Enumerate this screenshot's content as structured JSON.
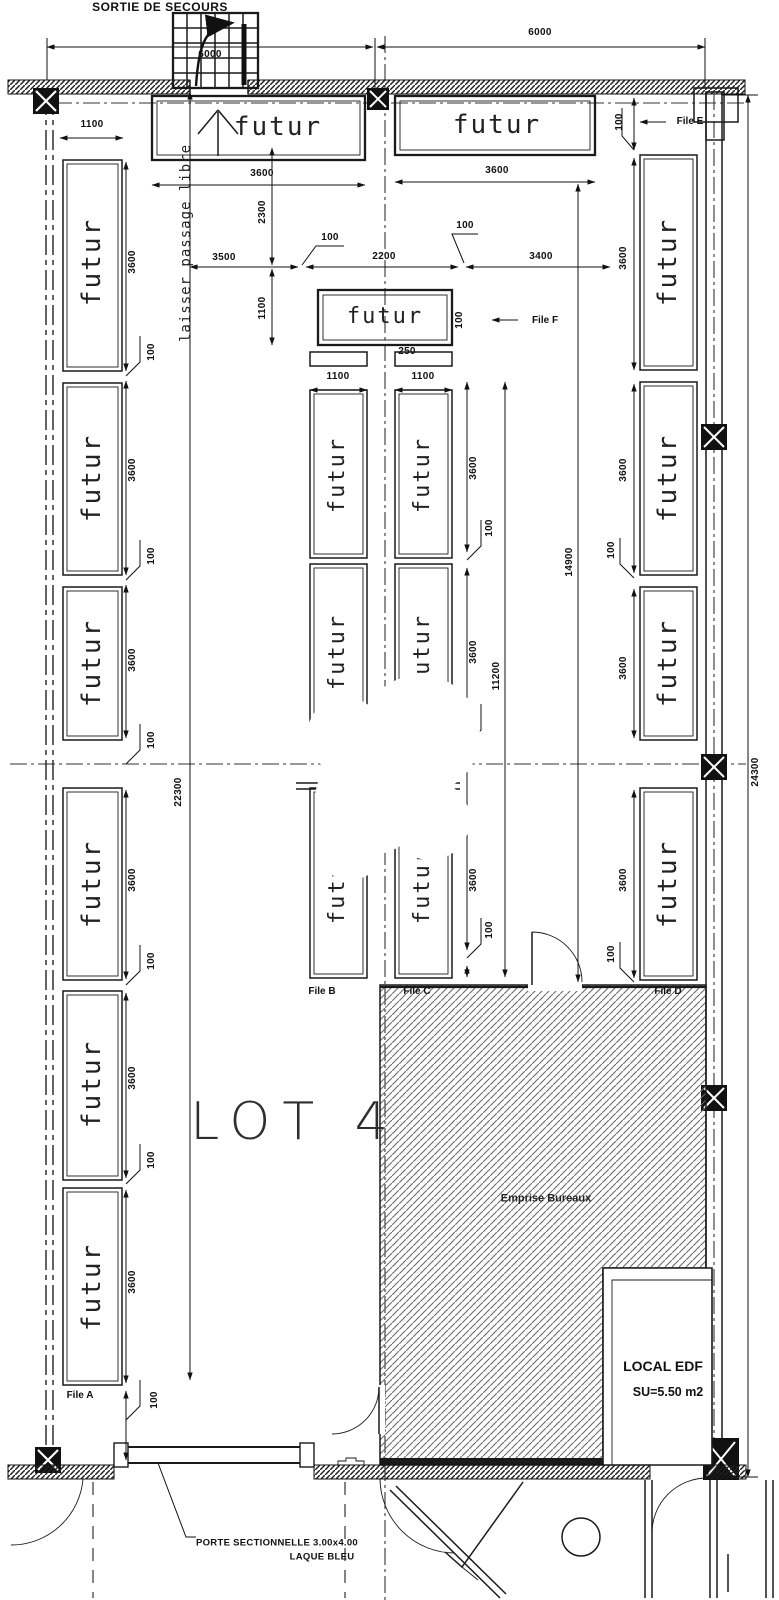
{
  "drawing": {
    "exit_label": "SORTIE DE SECOURS",
    "rack_label": "futur",
    "passage_note": "laisser passage libre",
    "lot_label": "LOT 4",
    "emprise_label": "Emprise Bureaux",
    "local_edf_name": "LOCAL EDF",
    "local_edf_area": "SU=5.50 m2",
    "door_note_1": "PORTE SECTIONNELLE 3.00x4.00",
    "door_note_2": "LAQUE BLEU"
  },
  "files": {
    "a": "File A",
    "b": "File B",
    "c": "File C",
    "d": "File D",
    "e": "File E",
    "f": "File F"
  },
  "dims": {
    "d6000": "6000",
    "d3600": "3600",
    "d3500": "3500",
    "d3400": "3400",
    "d2300": "2300",
    "d2200": "2200",
    "d1100": "1100",
    "d250": "250",
    "d100": "100",
    "d22300": "22300",
    "d24300": "24300",
    "d14900": "14900",
    "d11200": "11200"
  }
}
